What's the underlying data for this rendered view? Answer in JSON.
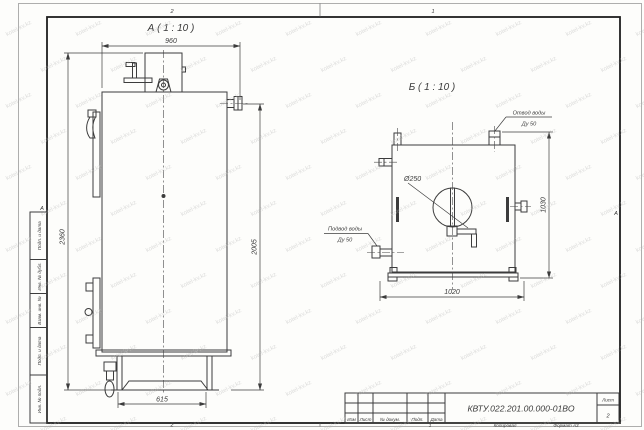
{
  "sheet": {
    "zones": {
      "top_left": "2",
      "top_right": "1",
      "bottom_left": "2",
      "bottom_right": "1"
    },
    "fold_marks": {
      "left": "А",
      "right": "А"
    },
    "colors": {
      "paper": "#fdfdfb",
      "line": "#3c3c3c",
      "frame": "#1e1e1e",
      "watermark": "#b5b5b5"
    }
  },
  "watermark": {
    "text": "kotel-kv.kz"
  },
  "view_a": {
    "title": "А ( 1 : 10 )",
    "dim_width_top": "960",
    "dim_height_overall": "2360",
    "dim_height_right": "2005",
    "dim_base_width": "615"
  },
  "view_b": {
    "title": "Б ( 1 : 10 )",
    "dim_width_bottom": "1020",
    "dim_height_right": "1030",
    "hole_diameter": "Ø250",
    "outlet_label": "Отвод воды",
    "outlet_size": "Ду 50",
    "inlet_label": "Подвод воды",
    "inlet_size": "Ду 50"
  },
  "side_stamp": {
    "items": [
      "Подп. и дата",
      "Инв. № дубл.",
      "Взам. инв. №",
      "Подп. и дата",
      "Инв. № подл."
    ]
  },
  "title_block": {
    "doc_number": "КВТУ.022.201.00.000-01ВО",
    "sheet_label": "Лист",
    "sheet_number": "2",
    "columns": [
      "Изм",
      "Лист",
      "№ докум.",
      "Подп.",
      "Дата"
    ],
    "footer": {
      "zone": "1",
      "copy_label": "Копировал",
      "format_label": "Формат А3"
    }
  }
}
